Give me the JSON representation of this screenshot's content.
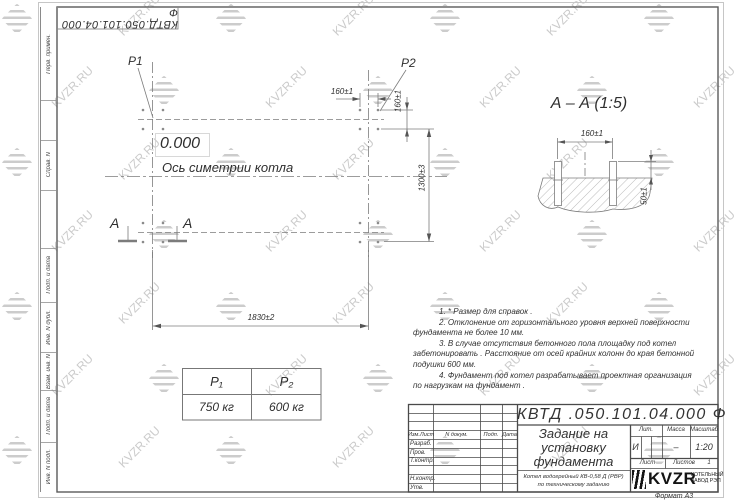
{
  "sheet": {
    "doc_number_top": "КВТД.050.101.04.000 Ф",
    "format_label": "Формат А3"
  },
  "watermark": {
    "text": "KVZR.RU"
  },
  "margin": {
    "labels": [
      "Перв. примен.",
      "Справ. N",
      "Подп. и дата",
      "Инв. N дубл.",
      "Взам. инв. N",
      "Подп. и дата",
      "Инв. N подл."
    ]
  },
  "plan": {
    "p1_label": "P1",
    "p2_label": "P2",
    "elevation": "0.000",
    "axis_label": "Ось симетрии котла",
    "section_letter": "А",
    "dim_width": "1830±2",
    "dim_height": "1300±3",
    "dim_bolt_spacing_x": "160±1",
    "dim_bolt_spacing_y": "160±1"
  },
  "section_view": {
    "title": "А – А (1:5)",
    "dim_bolt_spacing": "160±1",
    "dim_protrusion": "50±1"
  },
  "load_table": {
    "col1_header": "P₁",
    "col2_header": "P₂",
    "col1_value": "750 кг",
    "col2_value": "600 кг"
  },
  "notes": {
    "lines": [
      "1.  * Размер для справок .",
      "2.  Отклонение от горизонтального уровня верхней поверхности",
      "фундамента не более 10 мм.",
      "3.  В случае отсутствия бетонного пола площадку под котел",
      "забетонировать . Расстояние от осей крайних колонн до края бетонной",
      "подушки 600 мм.",
      "4.  Фундамент под котел разрабатывает проектная организация",
      "по нагрузкам на фундамент ."
    ]
  },
  "title_block": {
    "doc_number": "КВТД .050.101.04.000  Ф",
    "title_lines": [
      "Задание на",
      "установку",
      "фундамента"
    ],
    "product_lines": [
      "Котел водогрейный КВ-0,58 Д (РВР)",
      "по техническому заданию"
    ],
    "header_cols": [
      "Изм.Лист",
      "N докум.",
      "Подп.",
      "Дата"
    ],
    "sign_rows": [
      "Разраб.",
      "Пров.",
      "Т.контр.",
      "Н.контр.",
      "Утв."
    ],
    "lit_label": "Лит.",
    "mass_label": "Масса",
    "scale_label": "Масштаб",
    "lit_value": "И",
    "mass_value": "–",
    "scale_value": "1:20",
    "sheet_label": "Лист",
    "sheets_label": "Листов",
    "sheets_value": "1",
    "logo_text": "KVZR",
    "logo_caption_lines": [
      "КОТЕЛЬНЫЙ",
      "ЗАВОД РЭП"
    ]
  }
}
